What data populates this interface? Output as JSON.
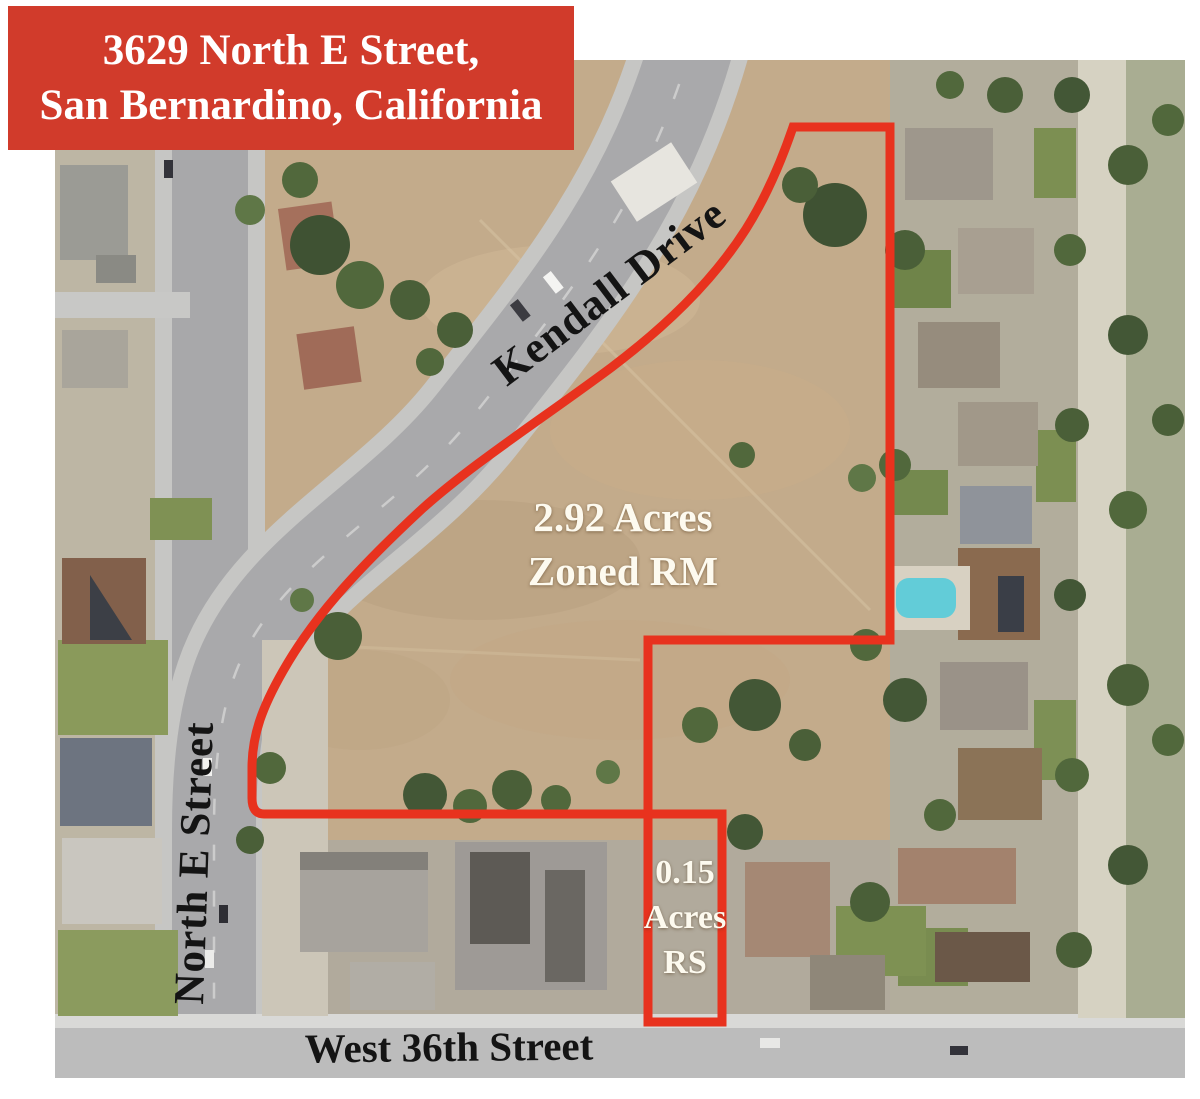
{
  "title_box": {
    "line1": "3629 North E Street,",
    "line2": "San Bernardino, California"
  },
  "map_labels": {
    "kendall_drive": "Kendall Drive",
    "north_e_street": "North E Street",
    "west_36th_street": "West 36th Street",
    "main_parcel": {
      "line1": "2.92 Acres",
      "line2": "Zoned RM"
    },
    "small_parcel": {
      "line1": "0.15",
      "line2": "Acres",
      "line3": "RS"
    }
  },
  "colors": {
    "title_box_bg": "#d13b2b",
    "title_text": "#ffffff",
    "parcel_boundary": "#e8321e",
    "road_label_text": "#141414",
    "parcel_label_text": "#fdfaef"
  }
}
